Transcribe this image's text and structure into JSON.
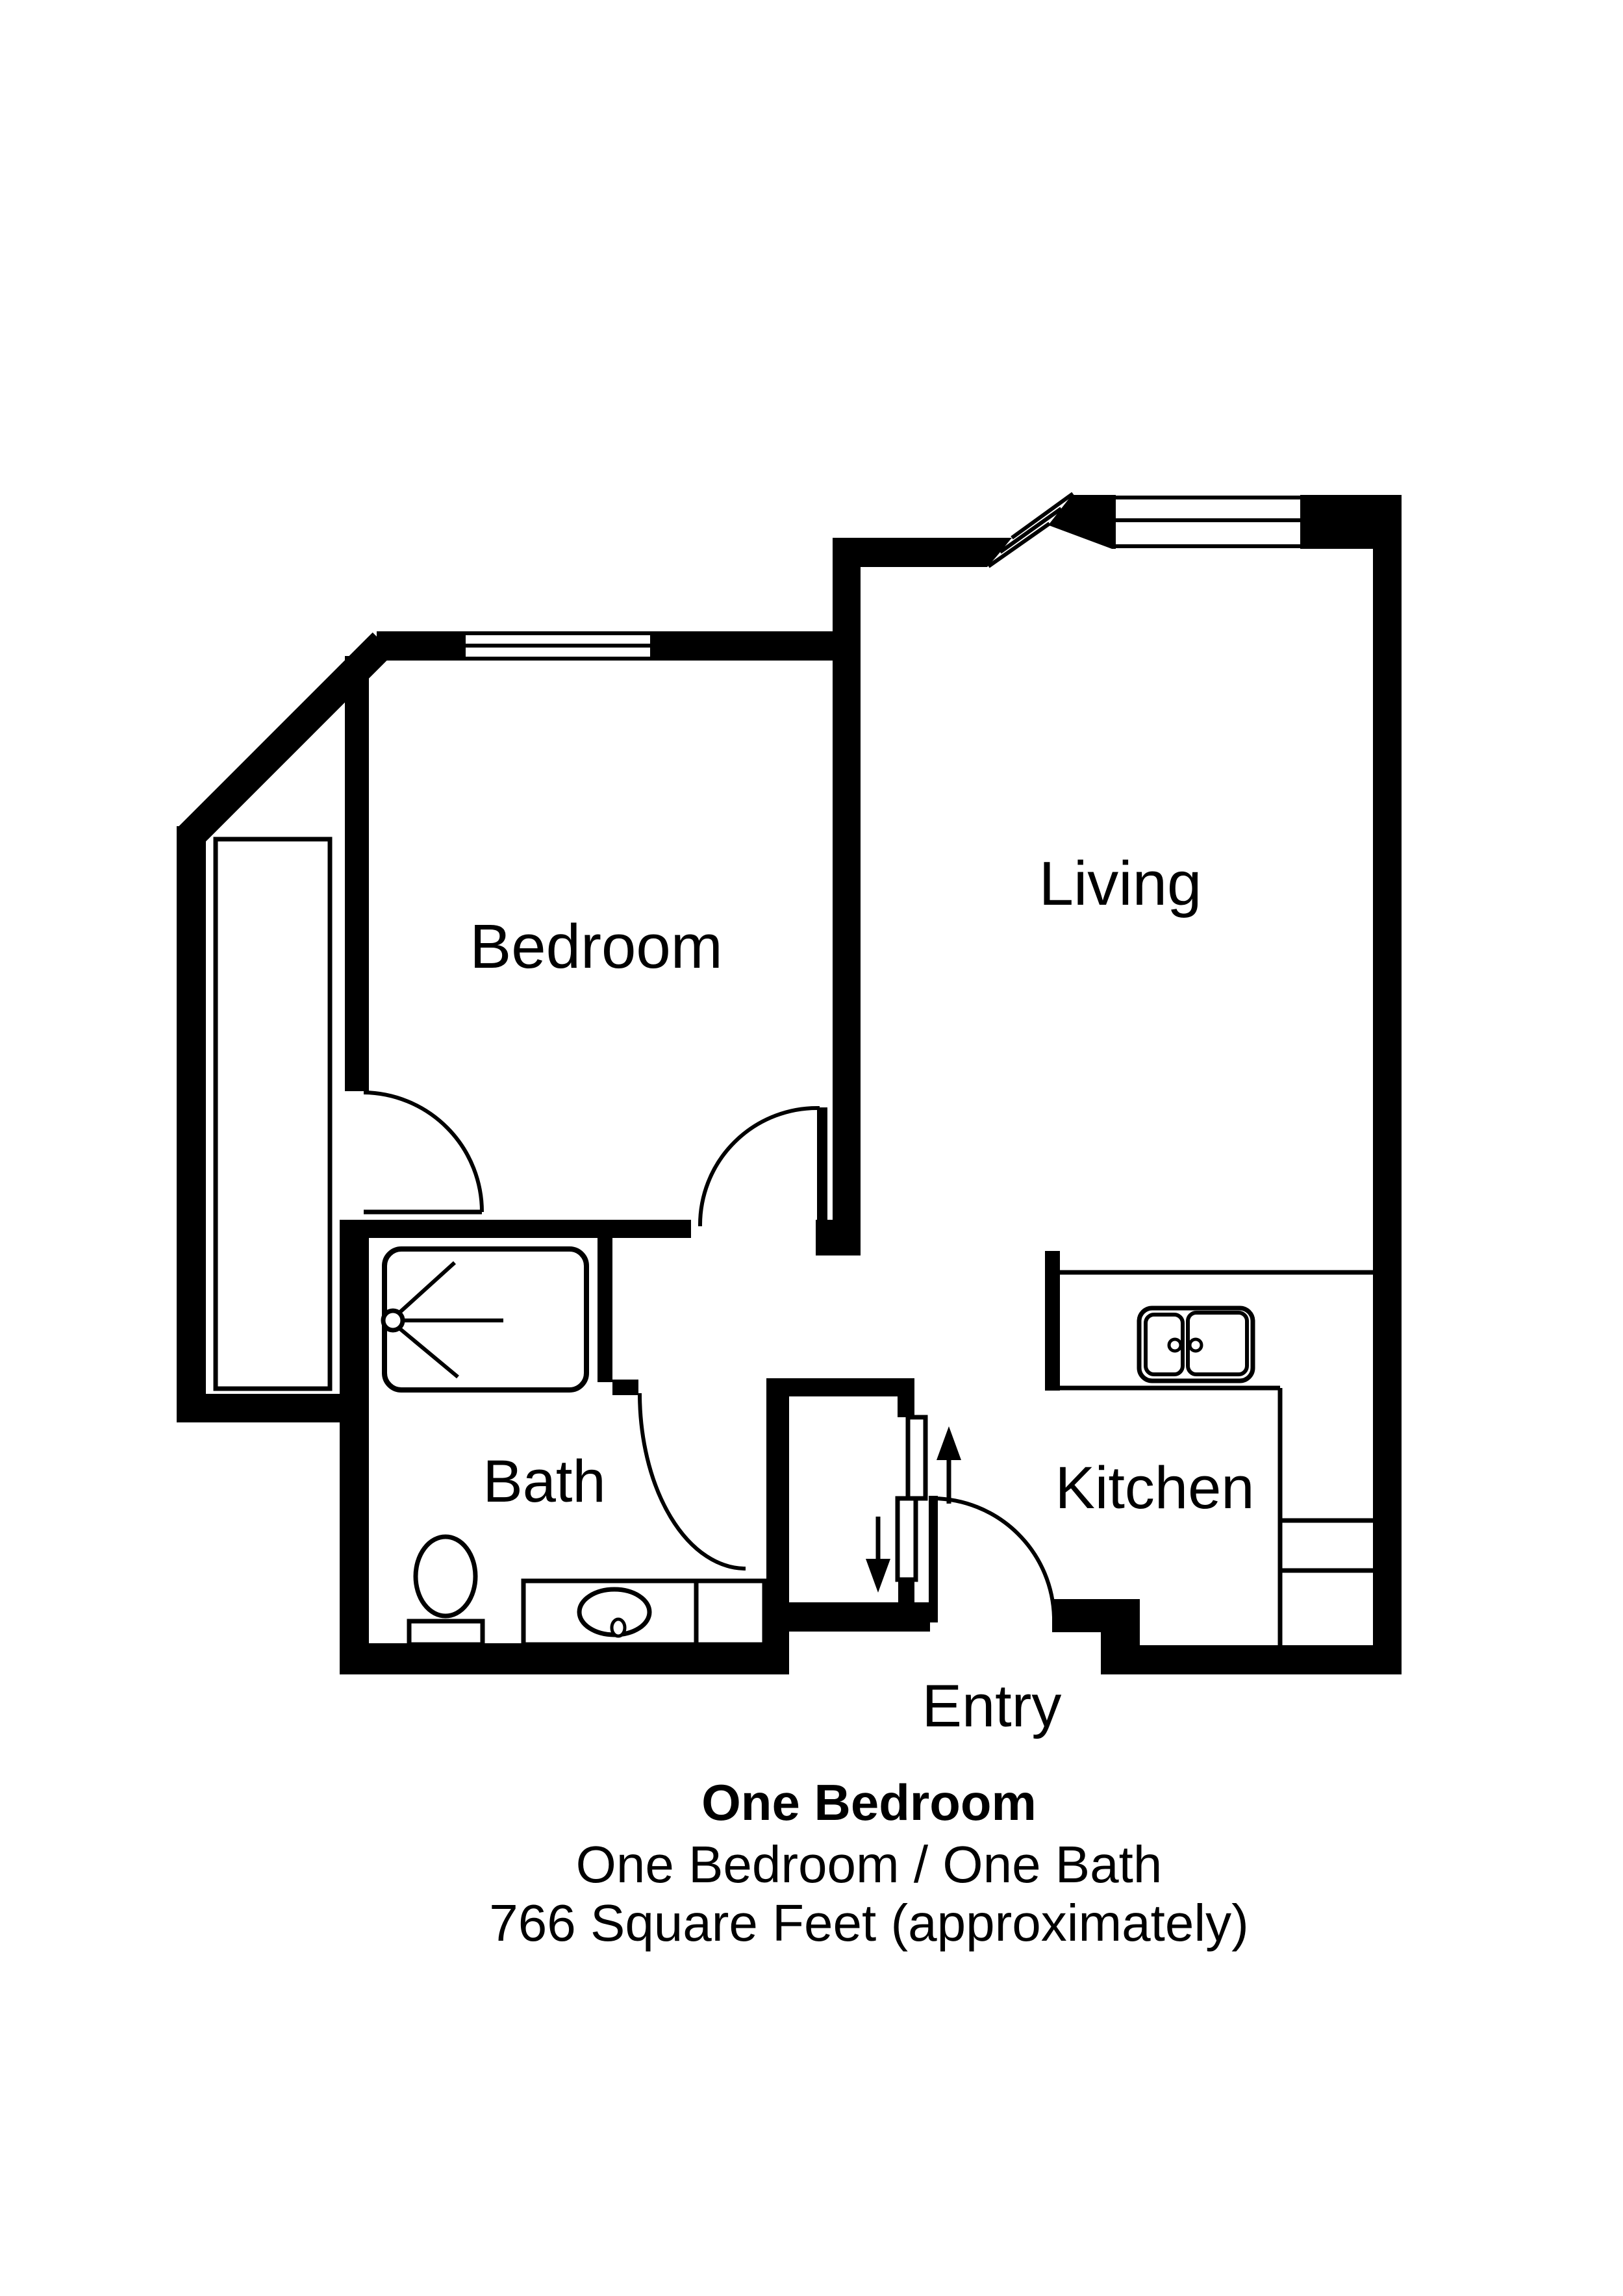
{
  "colors": {
    "paper": "#ffffff",
    "ink": "#000000"
  },
  "floorplan": {
    "rooms": [
      {
        "id": "bedroom",
        "label": "Bedroom"
      },
      {
        "id": "living",
        "label": "Living"
      },
      {
        "id": "bath",
        "label": "Bath"
      },
      {
        "id": "kitchen",
        "label": "Kitchen"
      },
      {
        "id": "entry",
        "label": "Entry"
      }
    ],
    "fixtures": [
      {
        "name": "shower-with-sprayhead",
        "room": "bath"
      },
      {
        "name": "toilet",
        "room": "bath"
      },
      {
        "name": "vanity-sink",
        "room": "bath"
      },
      {
        "name": "double-basin-sink",
        "room": "kitchen"
      },
      {
        "name": "counter",
        "room": "kitchen"
      },
      {
        "name": "wardrobe-closet",
        "room": "bedroom"
      },
      {
        "name": "sliding-bypass-doors",
        "room": "entry"
      }
    ],
    "doors": [
      "bedroom-door",
      "bedroom-closet-door",
      "bath-door",
      "entry-door"
    ],
    "windows": [
      "bedroom-window",
      "living-bay-window",
      "living-window"
    ]
  },
  "caption": {
    "title": "One Bedroom",
    "subtitle": "One Bedroom / One Bath",
    "area": "766 Square Feet (approximately)"
  }
}
